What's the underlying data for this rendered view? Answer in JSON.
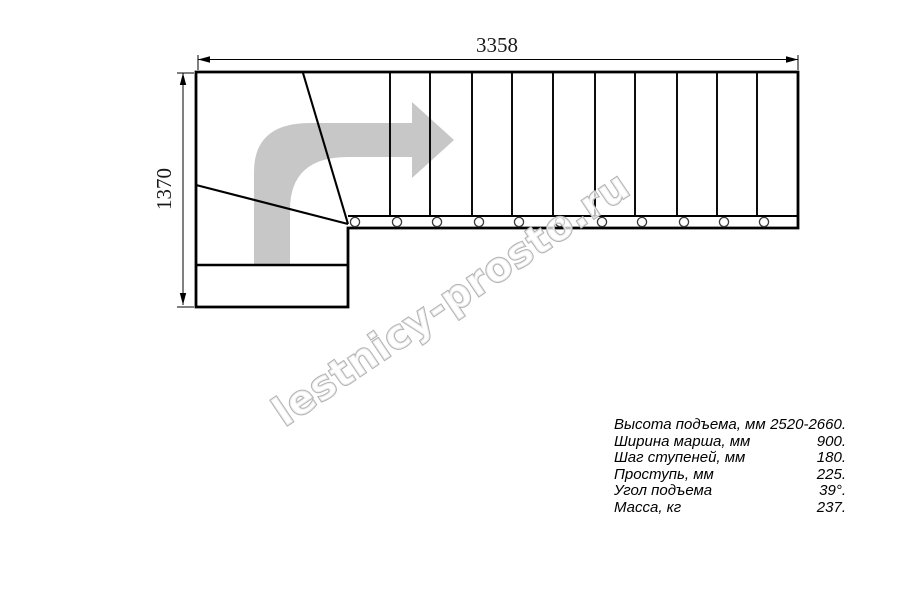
{
  "drawing": {
    "title": "L-shaped staircase plan view",
    "dim_width_label": "3358",
    "dim_height_label": "1370",
    "straight_tread_count": 11,
    "baluster_count": 11
  },
  "watermark": {
    "text": "lestnicy-prosto.ru"
  },
  "specs": {
    "rows": [
      {
        "label": "Высота подъема, мм",
        "value": "2520-2660."
      },
      {
        "label": "Ширина марша, мм",
        "value": "900."
      },
      {
        "label": "Шаг ступеней, мм",
        "value": "180."
      },
      {
        "label": "Проступь, мм",
        "value": "225."
      },
      {
        "label": "Угол подъема",
        "value": "39°."
      },
      {
        "label": "Масса, кг",
        "value": "237."
      }
    ]
  },
  "colors": {
    "line": "#000000",
    "direction_arrow_gray": "#c7c7c7",
    "watermark_gray": "#b2b2b2",
    "background": "#ffffff"
  }
}
